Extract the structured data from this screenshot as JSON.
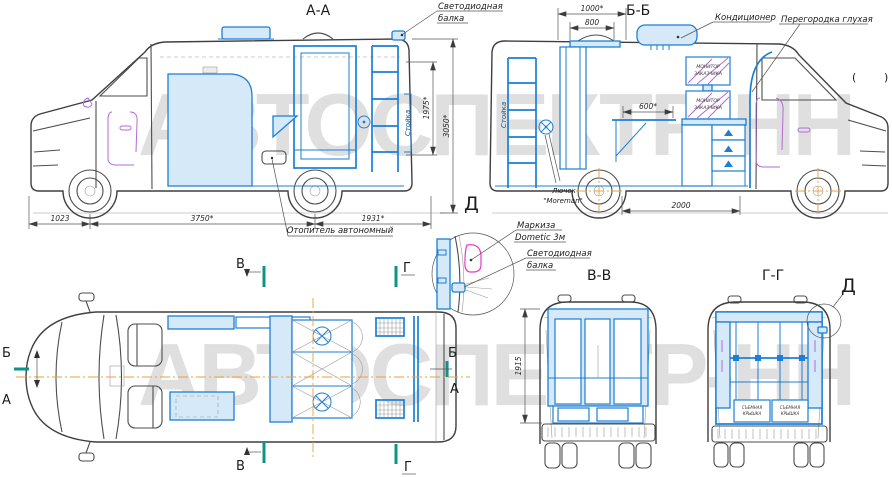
{
  "watermark": {
    "text": "АВТОСПЕКТР-НН"
  },
  "titles": {
    "aa": "А-А",
    "bb": "Б-Б",
    "vv": "В-В",
    "gg": "Г-Г"
  },
  "section_letters": {
    "d_bb": "Д",
    "d_gg": "Д",
    "b_left": "Б",
    "a_left": "А",
    "b_right": "Б",
    "a_right": "А",
    "v_top": "В",
    "v_bottom": "В",
    "g_top": "Г",
    "g_bottom": "Г"
  },
  "callouts": {
    "led1": "Светодиодная",
    "led2": "балка",
    "heater": "Отопитель автономный",
    "ac": "Кондиционер",
    "partition": "Перегородка глухая",
    "hatch1": "Лючок",
    "hatch2": "\"Moreman\"",
    "awning1": "Маркиза",
    "awning2": "Dometic 3м",
    "dled1": "Светодиодная",
    "dled2": "балка",
    "rack_aa": "Стойка",
    "rack_bb": "Стойка",
    "monitor1": "МОНИТОР",
    "monitor2": "ЗАКАЗЧИКА",
    "cover1": "СЪЕМНАЯ",
    "cover2": "КРЫШКА"
  },
  "dims": {
    "d1023": "1023",
    "d3750": "3750*",
    "d1931": "1931*",
    "d3050": "3050*",
    "d1975": "1975*",
    "d1000": "1000*",
    "d800": "800",
    "d600": "600*",
    "d2000": "2000",
    "d1915": "1915"
  },
  "misc": {
    "mark_left": "(",
    "mark_right": ")"
  }
}
